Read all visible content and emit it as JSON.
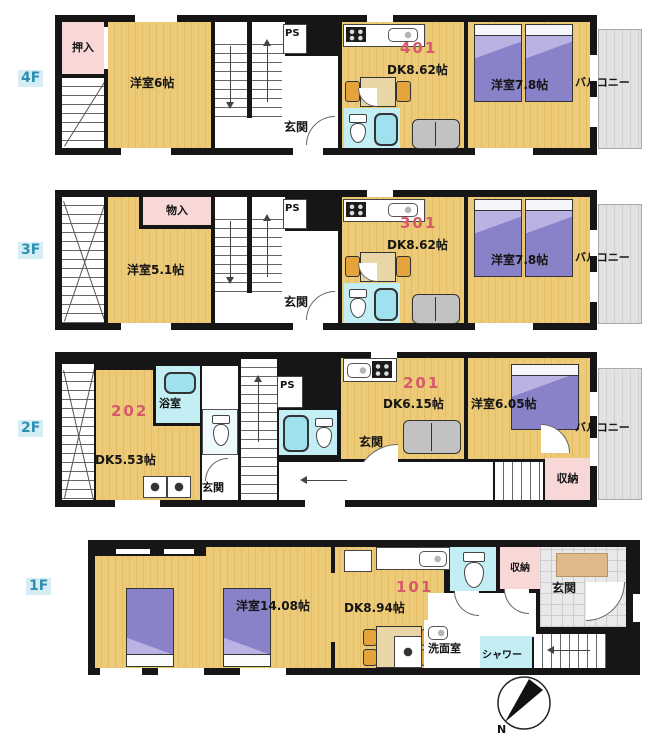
{
  "colors": {
    "wall": "#161616",
    "floor_tan": "#eac873",
    "bath_cyan": "#c2eef4",
    "closet_pink": "#f8d7d7",
    "bed_purple": "#8a82c8",
    "balcony_gray": "#dddddd",
    "unit_number_red": "#d9596c",
    "floor_label_teal": "#2e8fb0",
    "chair_orange": "#e5a33c"
  },
  "floors": [
    {
      "label": "4F",
      "unit_number": "401",
      "labels": {
        "oshiire": "押入",
        "west_room": "洋室6帖",
        "ps": "PS",
        "genkan": "玄関",
        "dk": "DK8.62帖",
        "west_room_2": "洋室7.8帖",
        "balcony": "バルコニー"
      }
    },
    {
      "label": "3F",
      "unit_number": "301",
      "labels": {
        "monoire": "物入",
        "west_room": "洋室5.1帖",
        "ps": "PS",
        "genkan": "玄関",
        "dk": "DK8.62帖",
        "west_room_2": "洋室7.8帖",
        "balcony": "バルコニー"
      }
    },
    {
      "label": "2F",
      "units": {
        "left": "202",
        "right": "201"
      },
      "labels": {
        "bath": "浴室",
        "dk_left": "DK5.53帖",
        "genkan_left": "玄関",
        "ps": "PS",
        "dk_right": "DK6.15帖",
        "west_room": "洋室6.05帖",
        "genkan_right": "玄関",
        "storage": "収納",
        "balcony": "バルコニー"
      }
    },
    {
      "label": "1F",
      "unit_number": "101",
      "labels": {
        "west_room": "洋室14.08帖",
        "dk": "DK8.94帖",
        "storage": "収納",
        "genkan": "玄関",
        "washroom": "洗面室",
        "shower": "シャワー"
      }
    }
  ],
  "compass": {
    "north_label": "N"
  }
}
